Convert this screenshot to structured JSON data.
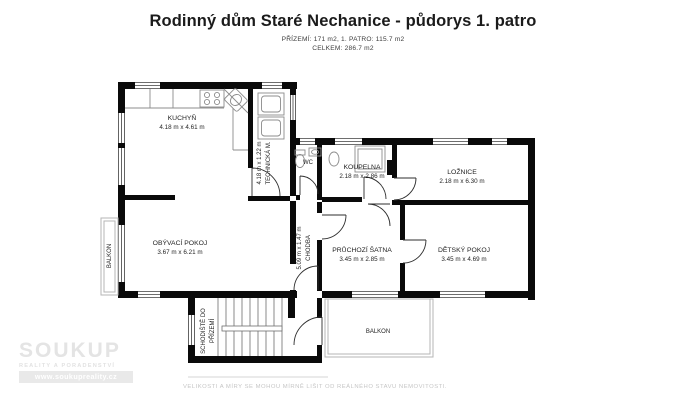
{
  "header": {
    "title": "Rodinný dům Staré Nechanice - půdorys 1. patro",
    "subtitle_line1": "PŘÍZEMÍ: 171 m2, 1. PATRO: 115.7 m2",
    "subtitle_line2": "CELKEM: 286.7 m2"
  },
  "rooms": {
    "kuchyn": {
      "name": "KUCHYŇ",
      "dims": "4.18 m x 4.61 m"
    },
    "technicka": {
      "name": "TECHNICKÁ M.",
      "dims": "4.18 m x 1.22 m"
    },
    "wc": {
      "name": "WC"
    },
    "koupelna": {
      "name": "KOUPELNA",
      "dims": "2.18 m x 2.86 m"
    },
    "loznice": {
      "name": "LOŽNICE",
      "dims": "2.18 m x 6.30 m"
    },
    "obyvaci": {
      "name": "OBÝVACÍ POKOJ",
      "dims": "3.67 m x 6.21 m"
    },
    "chodba": {
      "name": "CHODBA",
      "dims": "5.09 m x 1.47 m"
    },
    "satna": {
      "name": "PRŮCHOZÍ ŠATNA",
      "dims": "3.45 m x 2.85 m"
    },
    "detsky": {
      "name": "DĚTSKÝ POKOJ",
      "dims": "3.45 m x 4.69 m"
    },
    "schodiste": {
      "name_lines": [
        "SCHODIŠTĚ DO",
        "PŘÍZEMÍ"
      ]
    },
    "balkon_left": {
      "name": "BALKON"
    },
    "balkon_bottom": {
      "name": "BALKON"
    }
  },
  "watermark": {
    "brand": "SOUKUP",
    "tagline": "REALITY A PORADENSTVÍ",
    "website": "www.soukupreality.cz"
  },
  "footer": {
    "disclaimer": "VELIKOSTI A MÍRY SE MOHOU MÍRNĚ LIŠIT OD REÁLNÉHO STAVU NEMOVITOSTI."
  },
  "colors": {
    "wall": "#0a0a0a",
    "window_line": "#3f3f3f",
    "door_arc": "#2e2e2e",
    "fixture": "#8c8c8c",
    "balcony_outline": "#b5b5b5",
    "label": "#1f1f1f",
    "watermark": "#e4e4e4"
  }
}
